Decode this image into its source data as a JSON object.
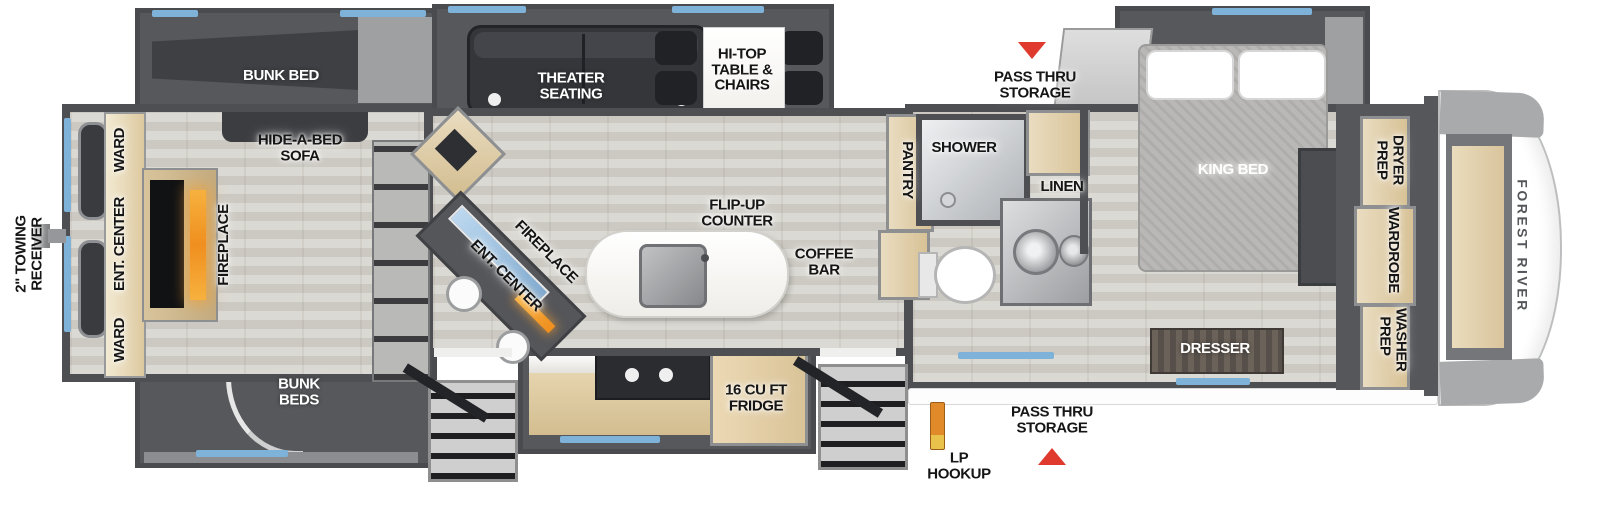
{
  "title": "Fifth wheel RV floor plan",
  "brand": {
    "front_cap_logo": "FOREST RIVER"
  },
  "labels": {
    "bunk_bed": "BUNK BED",
    "hide_a_bed_sofa": "HIDE-A-BED SOFA",
    "ward_top": "WARD",
    "ent_center_rear": "ENT. CENTER",
    "ward_bottom": "WARD",
    "fireplace_rear": "FIREPLACE",
    "towing_receiver": "2\" TOWING RECEIVER",
    "bunk_beds": "BUNK BEDS",
    "theater_seating": "THEATER SEATING",
    "hi_top_table": "HI-TOP TABLE & CHAIRS",
    "ent_center_mid": "ENT. CENTER",
    "fireplace_mid": "FIREPLACE",
    "flip_up_counter": "FLIP-UP COUNTER",
    "coffee_bar": "COFFEE BAR",
    "fridge": "16 CU FT FRIDGE",
    "lp_hookup": "LP HOOKUP",
    "pass_thru_bottom": "PASS THRU STORAGE",
    "pass_thru_top": "PASS THRU STORAGE",
    "pantry": "PANTRY",
    "shower": "SHOWER",
    "linen": "LINEN",
    "king_bed": "KING BED",
    "dresser": "DRESSER",
    "dryer_prep": "DRYER PREP",
    "wardrobe": "WARDROBE",
    "washer_prep": "WASHER PREP"
  },
  "colors": {
    "window_blue": "#7fb2d9",
    "arrow_red": "#e0392e",
    "fireplace_orange": "#f09a2e",
    "lp_pipe_orange": "#e08a2a",
    "cabinet_tan": "#dcc79e",
    "wall_gray": "#4e4f52",
    "slide_gray": "#57585c",
    "floor_gray": "#d5d3cd",
    "brand_text_gray": "#55565a"
  }
}
